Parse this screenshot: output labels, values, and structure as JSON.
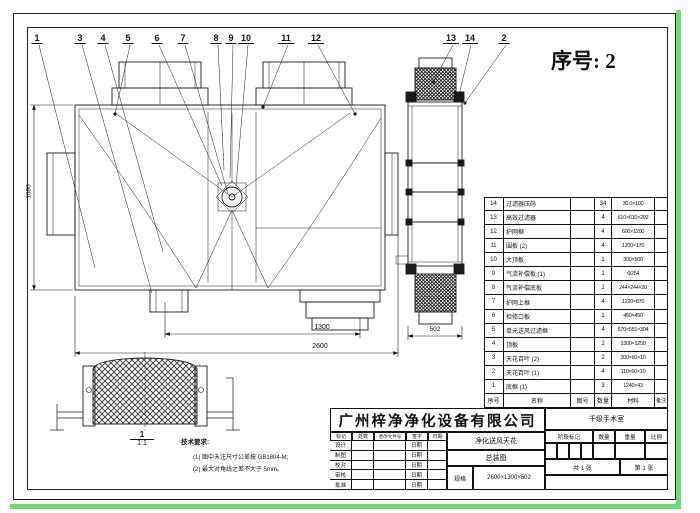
{
  "page": {
    "serial": "序号: 2"
  },
  "colors": {
    "line": "#1a1a1a",
    "green_edge": "#6ade6a",
    "paper": "#ffffff"
  },
  "callouts": [
    "1",
    "3",
    "4",
    "5",
    "6",
    "7",
    "8",
    "9",
    "10",
    "11",
    "12",
    "13",
    "14",
    "2"
  ],
  "dims": {
    "overall_width": "2600",
    "spigot_spacing": "1300",
    "height": "1080",
    "depth": "502"
  },
  "detail_label": {
    "number": "1",
    "scale": "1:1"
  },
  "tech_notes": {
    "title": "技术要求:",
    "items": [
      "(1) 图中未注尺寸公差按 GB1804-M;",
      "(2) 最大对角线之差不大于 5mm。"
    ]
  },
  "bom": {
    "headers": {
      "no": "序号",
      "name": "名称",
      "dwg": "图号",
      "qty": "数量",
      "material": "材料",
      "remark": "备注"
    },
    "rows": [
      {
        "no": "14",
        "name": "过滤器压码",
        "dwg": "",
        "qty": "34",
        "size": "30.0×100",
        "remark": ""
      },
      {
        "no": "13",
        "name": "高效过滤器",
        "dwg": "",
        "qty": "4",
        "size": "610×610×292",
        "remark": ""
      },
      {
        "no": "12",
        "name": "护网框",
        "dwg": "",
        "qty": "4",
        "size": "600×1200",
        "remark": ""
      },
      {
        "no": "11",
        "name": "围板 (2)",
        "dwg": "",
        "qty": "4",
        "size": "1200×170",
        "remark": ""
      },
      {
        "no": "10",
        "name": "大顶板",
        "dwg": "",
        "qty": "1",
        "size": "300×500",
        "remark": ""
      },
      {
        "no": "9",
        "name": "气流补偿板 (1)",
        "dwg": "",
        "qty": "1",
        "size": "Φ254",
        "remark": ""
      },
      {
        "no": "8",
        "name": "气流补偿底板",
        "dwg": "",
        "qty": "1",
        "size": "244×244×20",
        "remark": ""
      },
      {
        "no": "7",
        "name": "护网上框",
        "dwg": "",
        "qty": "4",
        "size": "1220×870",
        "remark": ""
      },
      {
        "no": "6",
        "name": "检修口板",
        "dwg": "",
        "qty": "1",
        "size": "450×450",
        "remark": ""
      },
      {
        "no": "5",
        "name": "单元送风过滤框",
        "dwg": "",
        "qty": "4",
        "size": "570×551×304",
        "remark": ""
      },
      {
        "no": "4",
        "name": "顶板",
        "dwg": "",
        "qty": "2",
        "size": "1300×1250",
        "remark": ""
      },
      {
        "no": "3",
        "name": "天花百叶 (2)",
        "dwg": "",
        "qty": "2",
        "size": "200×60×10",
        "remark": ""
      },
      {
        "no": "2",
        "name": "天花百叶 (1)",
        "dwg": "",
        "qty": "4",
        "size": "110×60×10",
        "remark": ""
      },
      {
        "no": "1",
        "name": "底框 (1)",
        "dwg": "",
        "qty": "3",
        "size": "1240×43",
        "remark": ""
      }
    ]
  },
  "title_block": {
    "company": "广州梓净净化设备有限公司",
    "project": "千级手术室",
    "product": "净化送风天花",
    "drawing_title": "总装图",
    "spec_label": "规格",
    "spec_value": "2600×1300×502",
    "revision_cols": [
      "标记",
      "处数",
      "更改文件号",
      "签字",
      "日期"
    ],
    "revision_rows": [
      {
        "label": "设计",
        "date": "日期"
      },
      {
        "label": "制图",
        "date": "日期"
      },
      {
        "label": "校对",
        "date": "日期"
      },
      {
        "label": "审核",
        "date": "日期"
      },
      {
        "label": "批准",
        "date": "日期"
      }
    ],
    "stage_cols": [
      "阶段标记",
      "数量",
      "重量",
      "比例"
    ],
    "sheets": {
      "total": "共 1 张",
      "current": "第 1 张"
    }
  }
}
